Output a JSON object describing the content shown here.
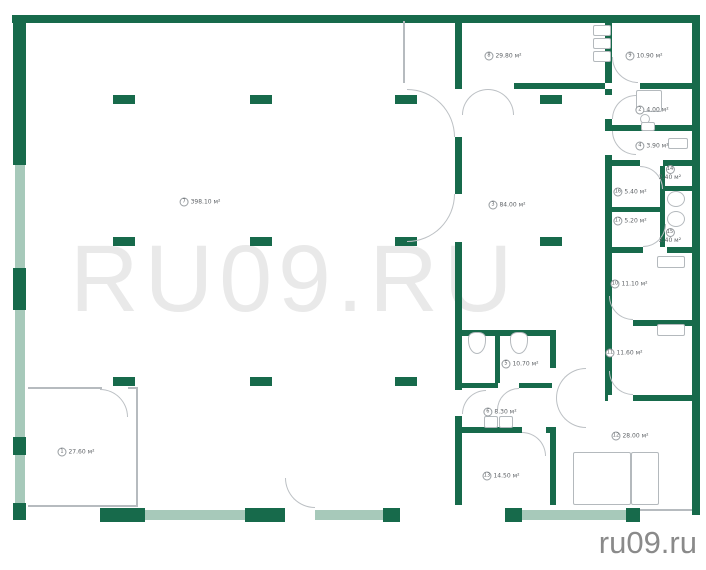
{
  "watermark": "RU09.RU",
  "footer": "ru09.ru",
  "colors": {
    "wall": "#176a4b",
    "window": "#a7c9ba",
    "line": "#b6bbbf"
  },
  "rooms": [
    {
      "n": "1",
      "area": "27.60 м²",
      "x": 76,
      "y": 452,
      "stacked": false
    },
    {
      "n": "2",
      "area": "4.00 м²",
      "x": 652,
      "y": 110,
      "stacked": false
    },
    {
      "n": "3",
      "area": "84.00 м²",
      "x": 507,
      "y": 205,
      "stacked": false
    },
    {
      "n": "4",
      "area": "3.90 м²",
      "x": 652,
      "y": 146,
      "stacked": false
    },
    {
      "n": "5",
      "area": "10.70 м²",
      "x": 520,
      "y": 364,
      "stacked": false
    },
    {
      "n": "6",
      "area": "8.30 м²",
      "x": 500,
      "y": 412,
      "stacked": false
    },
    {
      "n": "7",
      "area": "398.10 м²",
      "x": 200,
      "y": 202,
      "stacked": false
    },
    {
      "n": "8",
      "area": "29.80 м²",
      "x": 503,
      "y": 56,
      "stacked": false
    },
    {
      "n": "9",
      "area": "10.90 м²",
      "x": 644,
      "y": 56,
      "stacked": false
    },
    {
      "n": "10",
      "area": "11.10 м²",
      "x": 629,
      "y": 284,
      "stacked": false
    },
    {
      "n": "11",
      "area": "11.60 м²",
      "x": 624,
      "y": 353,
      "stacked": false
    },
    {
      "n": "12",
      "area": "28.00 м²",
      "x": 630,
      "y": 436,
      "stacked": false
    },
    {
      "n": "13",
      "area": "14.50 м²",
      "x": 501,
      "y": 476,
      "stacked": false
    },
    {
      "n": "14",
      "area": "2.40 м²",
      "x": 670,
      "y": 173,
      "stacked": true
    },
    {
      "n": "15",
      "area": "2.40 м²",
      "x": 670,
      "y": 236,
      "stacked": true
    },
    {
      "n": "16",
      "area": "5.40 м²",
      "x": 630,
      "y": 192,
      "stacked": false
    },
    {
      "n": "17",
      "area": "5.20 м²",
      "x": 630,
      "y": 221,
      "stacked": false
    }
  ],
  "plan": {
    "walls": [
      [
        12,
        15,
        688,
        8
      ],
      [
        692,
        15,
        8,
        500
      ],
      [
        13,
        15,
        13,
        150
      ],
      [
        13,
        268,
        13,
        42
      ],
      [
        13,
        437,
        13,
        18
      ],
      [
        13,
        503,
        13,
        17
      ],
      [
        100,
        508,
        45,
        14
      ],
      [
        245,
        508,
        40,
        14
      ],
      [
        383,
        508,
        17,
        14
      ],
      [
        505,
        508,
        17,
        14
      ],
      [
        626,
        508,
        14,
        14
      ],
      [
        455,
        21,
        7,
        62
      ],
      [
        605,
        20,
        7,
        63
      ],
      [
        455,
        83,
        7,
        6
      ],
      [
        514,
        83,
        91,
        6
      ],
      [
        640,
        83,
        52,
        6
      ],
      [
        455,
        137,
        7,
        57
      ],
      [
        455,
        242,
        7,
        88
      ],
      [
        455,
        330,
        7,
        60
      ],
      [
        455,
        416,
        7,
        14
      ],
      [
        455,
        430,
        7,
        75
      ],
      [
        458,
        330,
        94,
        6
      ],
      [
        495,
        336,
        5,
        47
      ],
      [
        458,
        383,
        40,
        5
      ],
      [
        519,
        383,
        33,
        5
      ],
      [
        458,
        427,
        64,
        6
      ],
      [
        546,
        427,
        10,
        6
      ],
      [
        550,
        330,
        6,
        38
      ],
      [
        550,
        428,
        6,
        77
      ],
      [
        605,
        89,
        7,
        6
      ],
      [
        605,
        119,
        7,
        12
      ],
      [
        605,
        155,
        7,
        240
      ],
      [
        605,
        125,
        87,
        6
      ],
      [
        605,
        160,
        35,
        6
      ],
      [
        663,
        160,
        29,
        6
      ],
      [
        660,
        166,
        5,
        81
      ],
      [
        663,
        186,
        29,
        5
      ],
      [
        605,
        207,
        57,
        5
      ],
      [
        605,
        247,
        38,
        6
      ],
      [
        667,
        247,
        25,
        6
      ],
      [
        605,
        320,
        3,
        6
      ],
      [
        633,
        320,
        59,
        6
      ],
      [
        605,
        395,
        3,
        6
      ],
      [
        633,
        395,
        59,
        6
      ]
    ],
    "windows": [
      [
        15,
        165,
        10,
        103
      ],
      [
        15,
        310,
        10,
        127
      ],
      [
        15,
        455,
        10,
        48
      ],
      [
        145,
        510,
        100,
        10
      ],
      [
        315,
        510,
        68,
        10
      ],
      [
        522,
        510,
        104,
        10
      ]
    ],
    "columns": [
      [
        113,
        95,
        22,
        9
      ],
      [
        250,
        95,
        22,
        9
      ],
      [
        395,
        95,
        22,
        9
      ],
      [
        540,
        95,
        22,
        9
      ],
      [
        113,
        237,
        22,
        9
      ],
      [
        250,
        237,
        22,
        9
      ],
      [
        395,
        237,
        22,
        9
      ],
      [
        540,
        237,
        22,
        9
      ],
      [
        113,
        377,
        22,
        9
      ],
      [
        250,
        377,
        22,
        9
      ],
      [
        395,
        377,
        22,
        9
      ]
    ],
    "thin_lines": [
      [
        403,
        21,
        2,
        62
      ],
      [
        28,
        387,
        74,
        2
      ],
      [
        128,
        387,
        10,
        2
      ],
      [
        136,
        387,
        2,
        120
      ],
      [
        28,
        505,
        110,
        2
      ],
      [
        640,
        509,
        52,
        2
      ]
    ],
    "doors": [
      [
        407,
        89,
        48,
        "tr"
      ],
      [
        407,
        194,
        48,
        "br"
      ],
      [
        462,
        89,
        26,
        "tl"
      ],
      [
        488,
        89,
        26,
        "tr"
      ],
      [
        612,
        57,
        26,
        "bl"
      ],
      [
        612,
        95,
        24,
        "tl"
      ],
      [
        612,
        131,
        24,
        "bl"
      ],
      [
        640,
        166,
        23,
        "tr"
      ],
      [
        643,
        224,
        23,
        "br"
      ],
      [
        609,
        296,
        24,
        "bl"
      ],
      [
        609,
        371,
        24,
        "bl"
      ],
      [
        556,
        368,
        30,
        "tl"
      ],
      [
        556,
        398,
        30,
        "bl"
      ],
      [
        497,
        388,
        22,
        "tl"
      ],
      [
        462,
        390,
        24,
        "tl"
      ],
      [
        285,
        478,
        30,
        "bl"
      ],
      [
        100,
        389,
        28,
        "tr"
      ],
      [
        522,
        432,
        24,
        "tr"
      ]
    ],
    "fixtures": [
      [
        593,
        25,
        18,
        11,
        "rect"
      ],
      [
        593,
        38,
        18,
        11,
        "rect"
      ],
      [
        593,
        51,
        18,
        11,
        "rect"
      ],
      [
        636,
        90,
        26,
        22,
        "rect"
      ],
      [
        640,
        114,
        10,
        10,
        "round"
      ],
      [
        641,
        122,
        14,
        9,
        "rect"
      ],
      [
        668,
        138,
        20,
        11,
        "rect"
      ],
      [
        667,
        191,
        18,
        16,
        "round"
      ],
      [
        667,
        211,
        18,
        16,
        "round"
      ],
      [
        657,
        256,
        28,
        12,
        "rect"
      ],
      [
        657,
        324,
        28,
        12,
        "rect"
      ],
      [
        468,
        332,
        18,
        22,
        "toilet"
      ],
      [
        510,
        332,
        18,
        22,
        "toilet"
      ],
      [
        484,
        416,
        14,
        12,
        "rect"
      ],
      [
        499,
        416,
        14,
        12,
        "rect"
      ],
      [
        573,
        452,
        58,
        53,
        "rect"
      ],
      [
        631,
        452,
        28,
        53,
        "rect"
      ]
    ]
  }
}
